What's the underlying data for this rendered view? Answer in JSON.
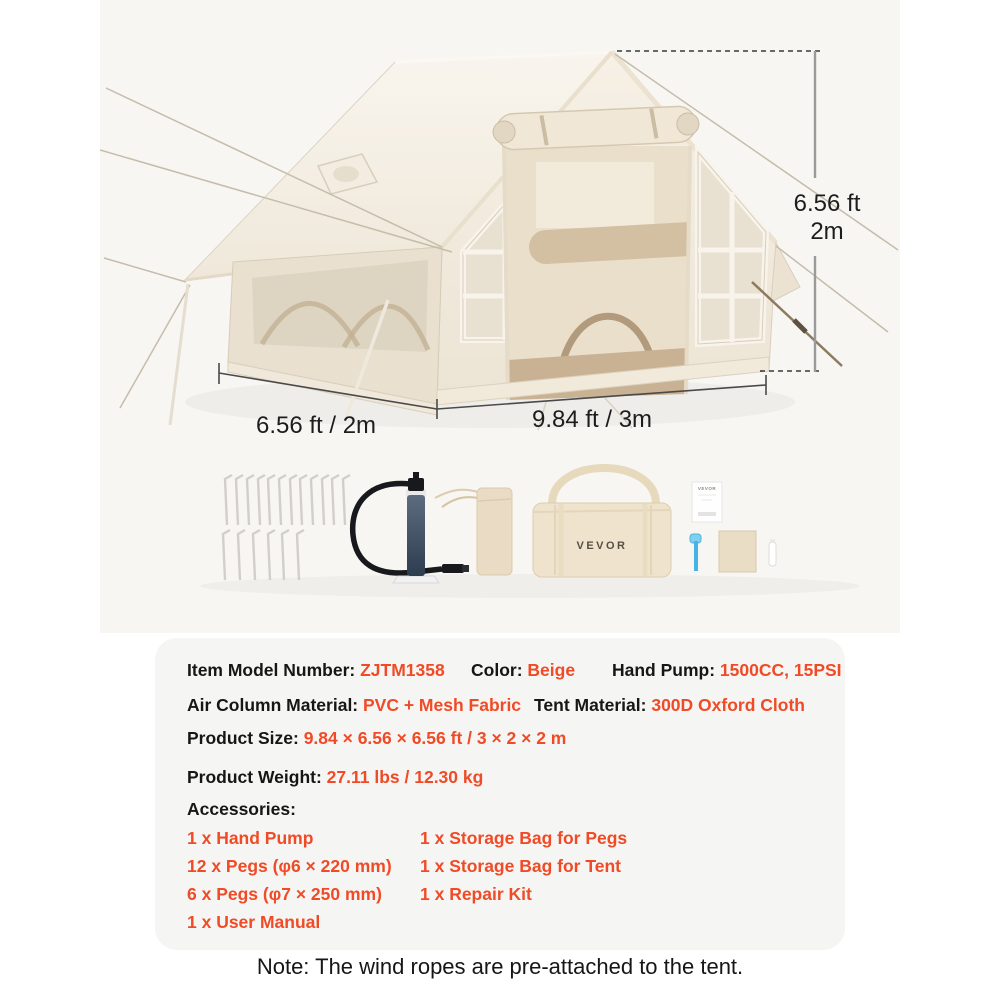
{
  "brand": "VEVOR",
  "colors": {
    "accent": "#F04B26",
    "text": "#161616",
    "photo_bg": "#f7f6f3",
    "panel_bg": "#f5f5f4",
    "dim_text": "#1d1d1d"
  },
  "photo": {
    "height_ft": "6.56 ft",
    "height_m": "2m",
    "depth_label": "6.56 ft / 2m",
    "width_label": "9.84 ft / 3m"
  },
  "specs": {
    "item_model_label": "Item Model Number: ",
    "item_model_value": "ZJTM1358",
    "color_label": "Color: ",
    "color_value": "Beige",
    "hand_pump_label": "Hand Pump: ",
    "hand_pump_value": "1500CC, 15PSI",
    "air_column_label": "Air Column Material: ",
    "air_column_value": "PVC + Mesh Fabric",
    "tent_material_label": "Tent Material: ",
    "tent_material_value": "300D Oxford Cloth",
    "size_label": "Product Size: ",
    "size_value": "9.84 × 6.56 × 6.56 ft / 3 × 2 × 2 m",
    "weight_label": "Product Weight: ",
    "weight_value": "27.11 lbs / 12.30 kg",
    "accessories_label": "Accessories:",
    "accessories_col1": [
      "1 x Hand Pump",
      "12 x Pegs (φ6 × 220 mm)",
      "6 x Pegs (φ7 × 250 mm)",
      "1 x User Manual"
    ],
    "accessories_col2": [
      "1 x Storage Bag for Pegs",
      "1 x Storage Bag for Tent",
      "1 x Repair Kit"
    ]
  },
  "note": "Note: The wind ropes are pre-attached to the tent."
}
